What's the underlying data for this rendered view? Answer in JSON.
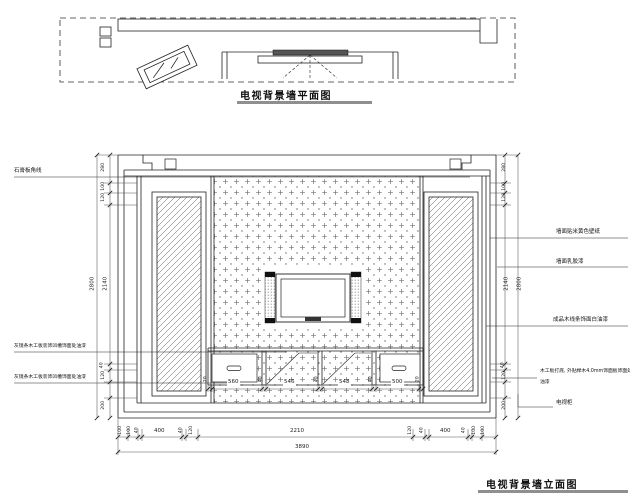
{
  "plan": {
    "title": "电视背景墙平面图"
  },
  "elevation": {
    "title": "电视背景墙立面图",
    "left_labels": {
      "l1": "石膏板角线",
      "l2": "灰镜条木工板装饰凹槽饰面处油漆",
      "l3": "灰镜条木工板装饰凹槽饰面处油漆"
    },
    "right_labels": {
      "r1": "墙面贴米黄色壁纸",
      "r2": "墙面乳胶漆",
      "r3": "成品木线条饰面白油漆",
      "r4a": "木工板打底, 外贴榉木4.0mm饰面板饰面处",
      "r4b": "油漆",
      "r5": "电视柜"
    },
    "dims": {
      "left": {
        "h280": "280",
        "h100": "100",
        "h120": "120",
        "total": "2800",
        "inner": "2140",
        "b40": "40",
        "b120": "120",
        "b200": "200"
      },
      "right": {
        "h280": "280",
        "h100": "100",
        "h120": "120",
        "total": "2800",
        "inner": "2140",
        "b40": "40",
        "b120": "120",
        "b200": "200"
      },
      "bottom": {
        "c1": "100",
        "c2": "100",
        "c3": "40",
        "s1": "400",
        "c4": "40",
        "c5": "120",
        "center": "2210",
        "c6": "120",
        "c7": "40",
        "s2": "400",
        "c8": "40",
        "c9": "100",
        "c10": "100",
        "total": "3890"
      },
      "cabinet": {
        "e1": "20",
        "w1": "560",
        "g1": "40",
        "w2": "546",
        "g2": "40",
        "w3": "548",
        "g3": "40",
        "w4": "500",
        "e2": "20"
      }
    }
  },
  "colors": {
    "line": "#222222",
    "underline": "#8f8f8f",
    "tv_fill": "#555555"
  }
}
